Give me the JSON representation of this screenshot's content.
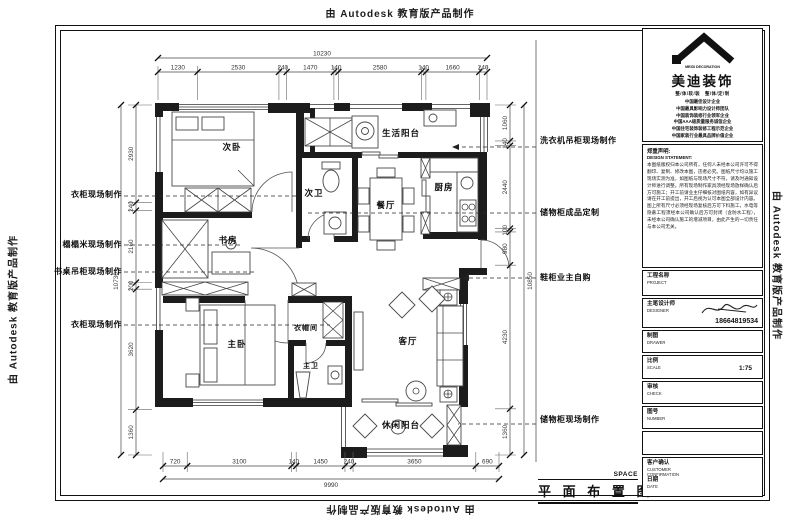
{
  "watermark": "由 Autodesk 教育版产品制作",
  "sheet_title": {
    "cn": "平 面 布 置 图",
    "en": "SPACE"
  },
  "rooms": {
    "bedroom2": "次卧",
    "balcony_life": "生活阳台",
    "bath2": "次卫",
    "dining": "餐厅",
    "kitchen": "厨房",
    "study": "书房",
    "master_bedroom": "主卧",
    "cloakroom": "衣帽间",
    "master_bath": "主卫",
    "living": "客厅",
    "balcony_leisure": "休闲阳台"
  },
  "annotations_left": [
    "衣柜现场制作",
    "榻榻米现场制作",
    "书桌吊柜现场制作",
    "衣柜现场制作"
  ],
  "annotations_right": [
    "洗衣机吊柜现场制作",
    "储物柜成品定制",
    "鞋柜业主自购",
    "储物柜现场制作"
  ],
  "dimensions": {
    "top": {
      "segments": [
        1230,
        2530,
        240,
        1470,
        140,
        2580,
        140,
        1660,
        240
      ],
      "total": 10230
    },
    "bottom": {
      "segments": [
        720,
        3100,
        140,
        1450,
        240,
        3650,
        690
      ],
      "total": 9990
    },
    "left": {
      "segments": [
        2930,
        240,
        2160,
        200,
        3620,
        1360
      ],
      "total": 10730
    },
    "right": {
      "segments": [
        1060,
        140,
        2440,
        100,
        980,
        4230,
        1360
      ],
      "total": 10850
    }
  },
  "titleblock": {
    "brand": {
      "logo_text": "MEIDI DECORATION",
      "name": "美迪装饰",
      "tagline": "整/体/软/装　整/体/定/制",
      "credentials": [
        "中国最佳设计企业",
        "中国最具影响力设计师团队",
        "中国装饰装修行业领军企业",
        "中国AAA级质量服务诚信企业",
        "中国住宅装饰装修工程示范企业",
        "中国家装行业最具品牌价值企业"
      ]
    },
    "statement": {
      "head_cn": "郑重声明:",
      "head_en": "DESIGN STATEMENT:",
      "body": "本图纸版权归本公司所有，任何人未经本公司许可不得翻印、复制、修改本图，违者必究。图纸尺寸均以施工现场实测为准，如图纸与现场尺寸不符，请及时通知设计师进行调整。所有现场制作家具须经现场放样确认后方可施工；开工前请业主仔细核对图纸内容，如有异议请在开工前提出，开工后视为认可本图全部设计内容。图上所有尺寸必须经现场复核后方可下料施工，水电等隐蔽工程须经本公司确认后方可封闭（含防水工程），未经本公司确认施工的增减项目，由此产生的一切责任与本公司无关。"
    },
    "project": {
      "cn": "工程名称",
      "en": "PROJECT"
    },
    "designer": {
      "cn": "主笔设计师",
      "en": "DESIGNER",
      "phone": "18664819534"
    },
    "drawer": {
      "cn": "制图",
      "en": "DRAWER"
    },
    "scale": {
      "cn": "比例",
      "en": "SCALE",
      "value": "1:75"
    },
    "check": {
      "cn": "审核",
      "en": "CHECK"
    },
    "number": {
      "cn": "图号",
      "en": "NUMBER"
    },
    "customer": {
      "cn": "客户确认",
      "en1": "CUSTOMER",
      "en2": "CONFIRMATION",
      "cn2": "日期",
      "en3": "DATE"
    }
  }
}
